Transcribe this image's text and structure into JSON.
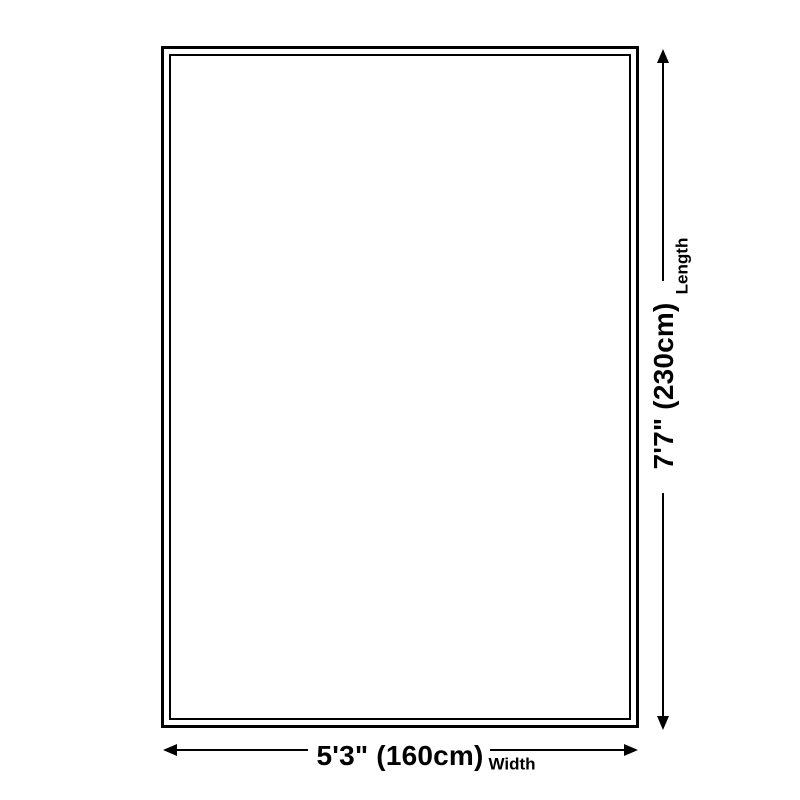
{
  "diagram": {
    "length": {
      "value": "7'7\" (230cm)",
      "label": "Length"
    },
    "width": {
      "value": "5'3\" (160cm)",
      "label": "Width"
    }
  },
  "colors": {
    "line": "#000000",
    "background": "#ffffff"
  }
}
